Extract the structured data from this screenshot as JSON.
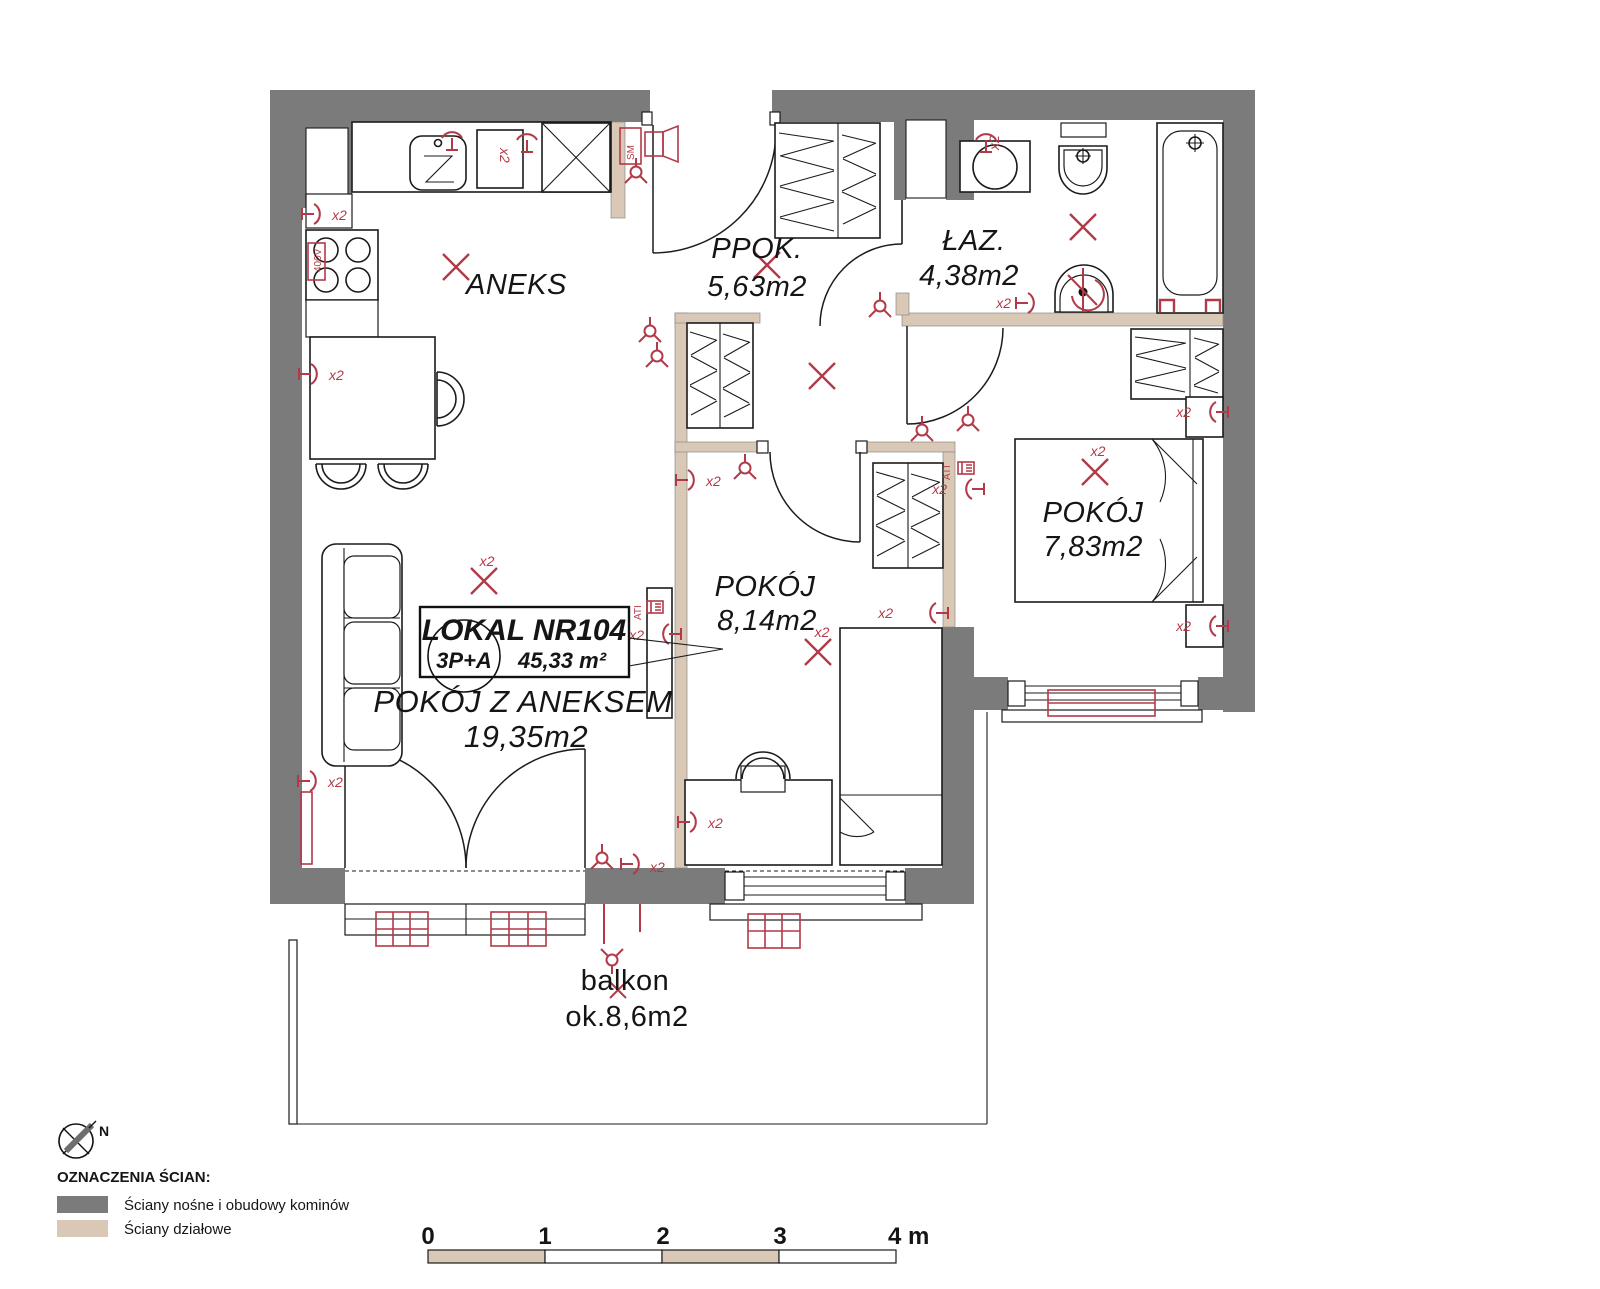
{
  "colors": {
    "wall": "#7b7b7b",
    "partition": "#d9c8b6",
    "accent": "#b23a48"
  },
  "unit": {
    "name": "LOKAL NR104",
    "layout": "3P+A",
    "area": "45,33 m²"
  },
  "rooms": [
    {
      "name": "ANEKS"
    },
    {
      "name": "PPOK.",
      "area": "5,63m2"
    },
    {
      "name": "ŁAZ.",
      "area": "4,38m2"
    },
    {
      "name": "POKÓJ",
      "area": "7,83m2"
    },
    {
      "name": "POKÓJ",
      "area": "8,14m2"
    },
    {
      "name": "POKÓJ Z ANEKSEM",
      "area": "19,35m2"
    },
    {
      "name": "balkon",
      "area": "ok.8,6m2"
    }
  ],
  "annotations": {
    "x2": "x2",
    "sm": "SM",
    "ati": "ATI",
    "v400": "400V",
    "north": "N"
  },
  "legend": {
    "heading": "OZNACZENIA ŚCIAN:",
    "items": [
      {
        "label": "Ściany nośne i obudowy kominów",
        "color": "#7b7b7b"
      },
      {
        "label": "Ściany działowe",
        "color": "#d9c8b6"
      }
    ]
  },
  "scale_bar": {
    "ticks": [
      "0",
      "1",
      "2",
      "3",
      "4 m"
    ]
  }
}
